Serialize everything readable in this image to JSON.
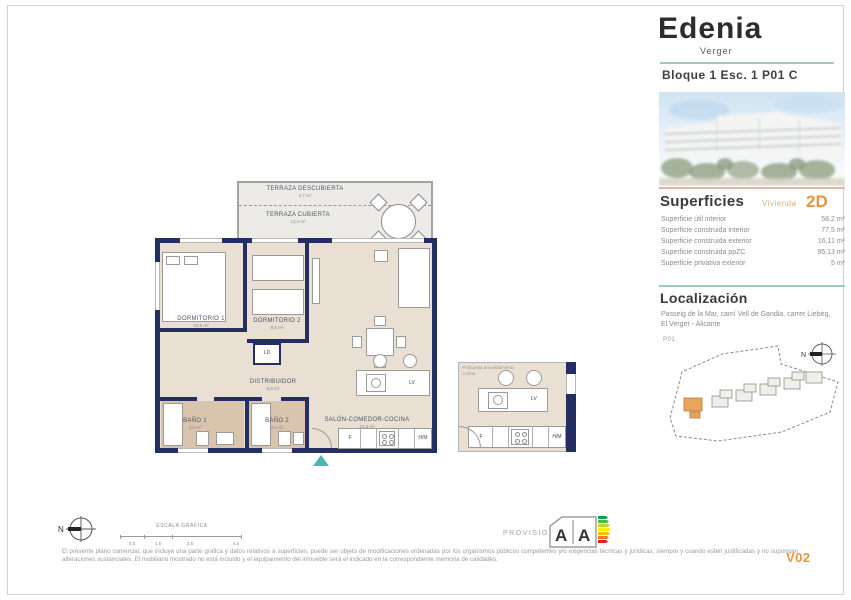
{
  "header": {
    "title": "Edenia",
    "subtitle": "Verger",
    "block_line": "Bloque 1 Esc. 1 P01 C"
  },
  "superficies": {
    "heading": "Superficies",
    "unit_label": "Vivienda",
    "unit_type": "2D",
    "rows": [
      {
        "label": "Superficie útil interior",
        "value": "58,2 m²"
      },
      {
        "label": "Superficie construida interior",
        "value": "77,5 m²"
      },
      {
        "label": "Superficie construida exterior",
        "value": "16,11 m²"
      },
      {
        "label": "Superficie construida ppZC",
        "value": "95,13 m²"
      },
      {
        "label": "Superficie privativa exterior",
        "value": "5 m²"
      }
    ]
  },
  "localizacion": {
    "heading": "Localización",
    "address": "Passeig de la Mar, camí Vell de Gandia, carrer Liebeg, El Verger - Alicante",
    "floor_label": "P01",
    "compass_n": "N"
  },
  "plan": {
    "terraza_descubierta": {
      "label": "TERRAZA DESCUBIERTA",
      "area": "2,7 m²"
    },
    "terraza_cubierta": {
      "label": "TERRAZA CUBIERTA",
      "area": "13,4 m²"
    },
    "dormitorio1": {
      "label": "DORMITORIO 1",
      "area": "10,9 m²"
    },
    "dormitorio2": {
      "label": "DORMITORIO 2",
      "area": "8,6 m²"
    },
    "distribuidor": {
      "label": "DISTRIBUIDOR",
      "area": "6,8 m²"
    },
    "bano1": {
      "label": "BAÑO 1",
      "area": "3,9 m²"
    },
    "bano2": {
      "label": "BAÑO 2",
      "area": "3,5 m²"
    },
    "salon": {
      "label": "SALÓN-COMEDOR-COCINA",
      "area": "24,5 m²"
    },
    "ld": "LD",
    "lv": "LV",
    "f": "F",
    "hm": "H/M",
    "detail": {
      "caption_line1": "Propuesta amueblamiento",
      "caption_line2": "cocina"
    },
    "compass_n": "N"
  },
  "footer": {
    "scale_label": "ESCALA GRÁFICA",
    "scale_ticks": [
      "0,5",
      "1,5",
      "2,5",
      "4,5"
    ],
    "provisional": "PROVISIONAL",
    "version": "V02",
    "disclaimer": "El presente plano comercial, que incluye una parte gráfica y datos relativos a superficies, puede ser objeto de modificaciones ordenadas por los organismos públicos competentes y/o exigencias técnicas y jurídicas, siempre y cuando estén justificadas y no supongan alteraciones sustanciales. El mobiliario mostrado no está incluido y el equipamiento del inmueble será el indicado en la correspondiente memoria de calidades."
  },
  "energy": {
    "a1": "A",
    "a2": "A"
  },
  "colors": {
    "accent_teal": "#49b8ae",
    "accent_orange": "#e8953f",
    "accent_salmon": "#e6b3a4",
    "wall_navy": "#242e63",
    "floor_beige": "#eadfd3",
    "bath_tan": "#d9c4ae",
    "energy_scale": [
      "#00a651",
      "#50b848",
      "#bed630",
      "#fff200",
      "#fdb913",
      "#f47b20",
      "#ed1c24"
    ]
  }
}
